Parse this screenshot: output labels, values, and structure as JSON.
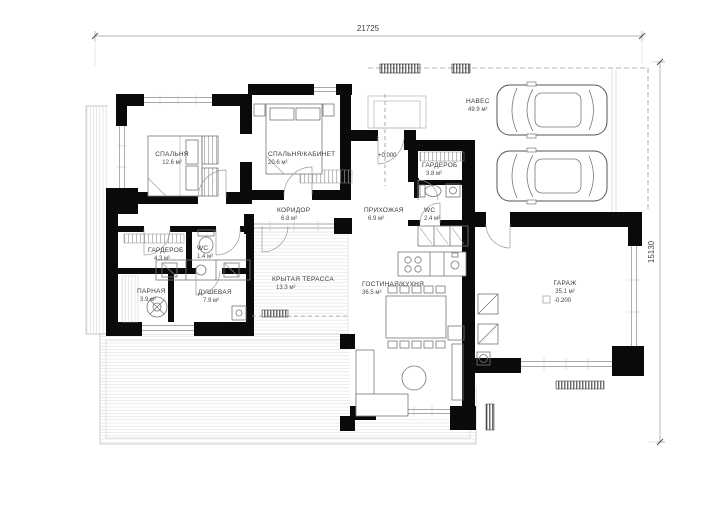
{
  "drawing": {
    "title_dimensions": {
      "width_total": "21725",
      "height_total": "15130"
    },
    "elevations": {
      "main_floor": "+0.000",
      "garage": "-0.200"
    },
    "rooms": [
      {
        "id": "bedroom",
        "name": "СПАЛЬНЯ",
        "area": "12.6 м²"
      },
      {
        "id": "bedroom-office",
        "name": "СПАЛЬНЯ/КАБИНЕТ",
        "area": "20.6 м²"
      },
      {
        "id": "carport",
        "name": "НАВЕС",
        "area": "49.9 м²"
      },
      {
        "id": "wardrobe-entry",
        "name": "ГАРДЕРОБ",
        "area": "3.8 м²"
      },
      {
        "id": "corridor",
        "name": "КОРИДОР",
        "area": "6.8 м²"
      },
      {
        "id": "hallway",
        "name": "ПРИХОЖАЯ",
        "area": "6.9 м²"
      },
      {
        "id": "wc",
        "name": "WC",
        "area": "2.4 м²"
      },
      {
        "id": "wardrobe",
        "name": "ГАРДЕРОБ",
        "area": "4.3 м²"
      },
      {
        "id": "wc-small",
        "name": "WC",
        "area": "1.4 м²"
      },
      {
        "id": "sauna",
        "name": "ПАРНАЯ",
        "area": "3.9 м²"
      },
      {
        "id": "shower",
        "name": "ДУШЕВАЯ",
        "area": "7.9 м²"
      },
      {
        "id": "covered-terrace",
        "name": "КРЫТАЯ ТЕРАССА",
        "area": "13.3 м²"
      },
      {
        "id": "living-kitchen",
        "name": "ГОСТИНАЯ/КУХНЯ",
        "area": "36.5 м²"
      },
      {
        "id": "garage",
        "name": "ГАРАЖ",
        "area": "35.1 м²"
      }
    ],
    "colors": {
      "wall": "#0a0a0a",
      "thin_line": "#8a8a8a",
      "hatch": "#dddddd",
      "text": "#3a3a3a",
      "background": "#ffffff"
    }
  }
}
